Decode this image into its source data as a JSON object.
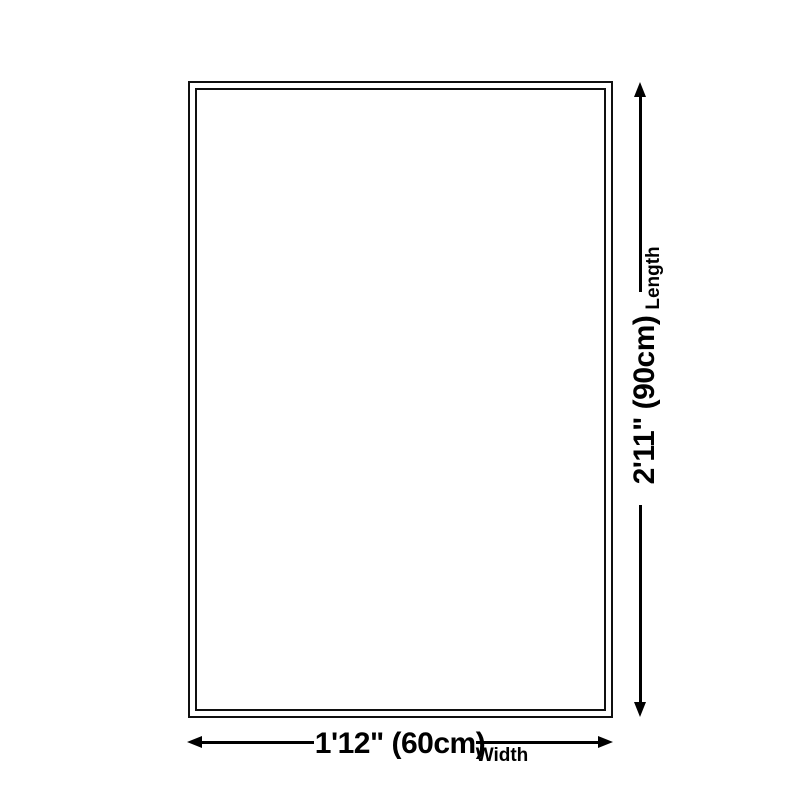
{
  "page": {
    "background": "#ffffff",
    "ink_color": "#000000",
    "border_color": "#101010"
  },
  "diagram": {
    "type": "product-size-diagram",
    "shape": "double-bordered-rectangle",
    "length": {
      "value": "2'11\" (90cm)",
      "label": "Length"
    },
    "width": {
      "value": "1'12\" (60cm)",
      "label": "Width"
    }
  }
}
